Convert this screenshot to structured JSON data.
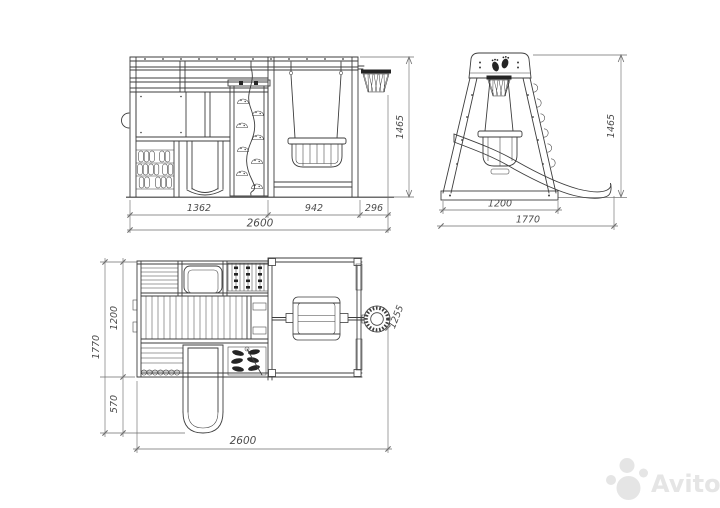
{
  "colors": {
    "line": "#3d3d3d",
    "ink": "#242424",
    "dim-line": "#6e6e6e",
    "dim-text": "#4c4c4c",
    "watermark": "#e5e5e5",
    "paper": "#ffffff"
  },
  "watermark": {
    "brand": "Avito"
  },
  "views": {
    "front": {
      "dims": {
        "section_tower": "1362",
        "section_swing": "942",
        "section_hoop": "296",
        "total_width": "2600",
        "height": "1465"
      }
    },
    "side": {
      "dims": {
        "base_width": "1200",
        "total_depth": "1770",
        "height": "1465"
      }
    },
    "plan": {
      "dims": {
        "depth_main": "1200",
        "depth_slide": "570",
        "depth_total": "1770",
        "total_width": "2600",
        "beam_to_front": "1255"
      }
    }
  }
}
